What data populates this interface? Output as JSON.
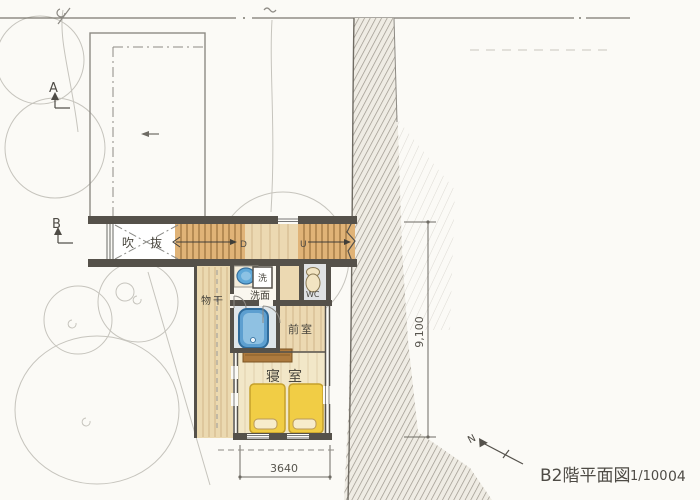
{
  "title_block": {
    "drawing_title": "B2階平面図",
    "scale": "1/100",
    "sheet_no": "04"
  },
  "markers": {
    "section_a": "A",
    "section_b": "B",
    "north": "N"
  },
  "rooms": {
    "void": "吹抜",
    "drying_deck": "物干",
    "washroom": "洗面",
    "washer": "洗",
    "toilet": "WC",
    "anteroom": "前室",
    "bedroom": "寝室"
  },
  "stairs": {
    "down_label": "D",
    "up_label": "U"
  },
  "dimensions": {
    "vertical_total": "9,100",
    "bedroom_width": "3640"
  },
  "colors": {
    "wall": "#55514a",
    "stair_wood": "#e0b377",
    "hall_wood": "#ecd9b2",
    "bedroom_floor": "#f2e7c8",
    "futon_yellow": "#f1cd45",
    "bathtub_blue": "#5d9fd0",
    "headboard_brown": "#ad7a3e",
    "ground_hatch": "#9a948a",
    "paper": "#fbfaf6"
  }
}
